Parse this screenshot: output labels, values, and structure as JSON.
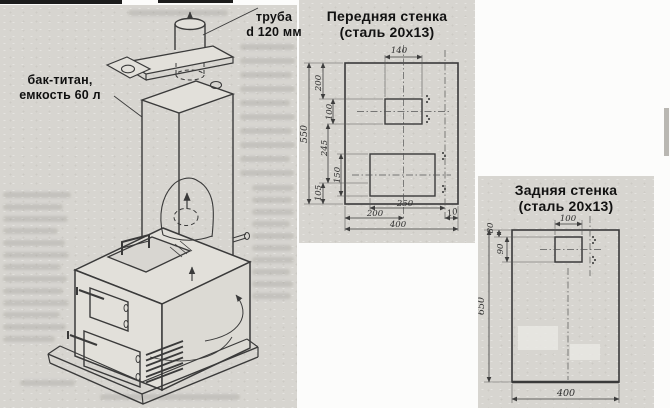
{
  "left_figure": {
    "pipe_label": {
      "line1": "труба",
      "line2": "d 120 мм"
    },
    "tank_label": {
      "line1": "бак-титан,",
      "line2": "емкость 60 л"
    }
  },
  "front_wall": {
    "title": {
      "line1": "Передняя стенка",
      "line2": "(сталь 20х13)"
    },
    "dims": {
      "top_width": "140",
      "height_200": "200",
      "height_100": "100",
      "overall_height": "550",
      "height_245": "245",
      "height_150": "150",
      "height_105": "105",
      "width_250": "250",
      "width_200": "200",
      "overall_width": "400",
      "offset_10": "10"
    }
  },
  "back_wall": {
    "title": {
      "line1": "Задняя стенка",
      "line2": "(сталь 20х13)"
    },
    "dims": {
      "hole_width": "100",
      "offset_80": "80",
      "hole_height_90": "90",
      "overall_height": "650",
      "overall_width": "400"
    }
  }
}
